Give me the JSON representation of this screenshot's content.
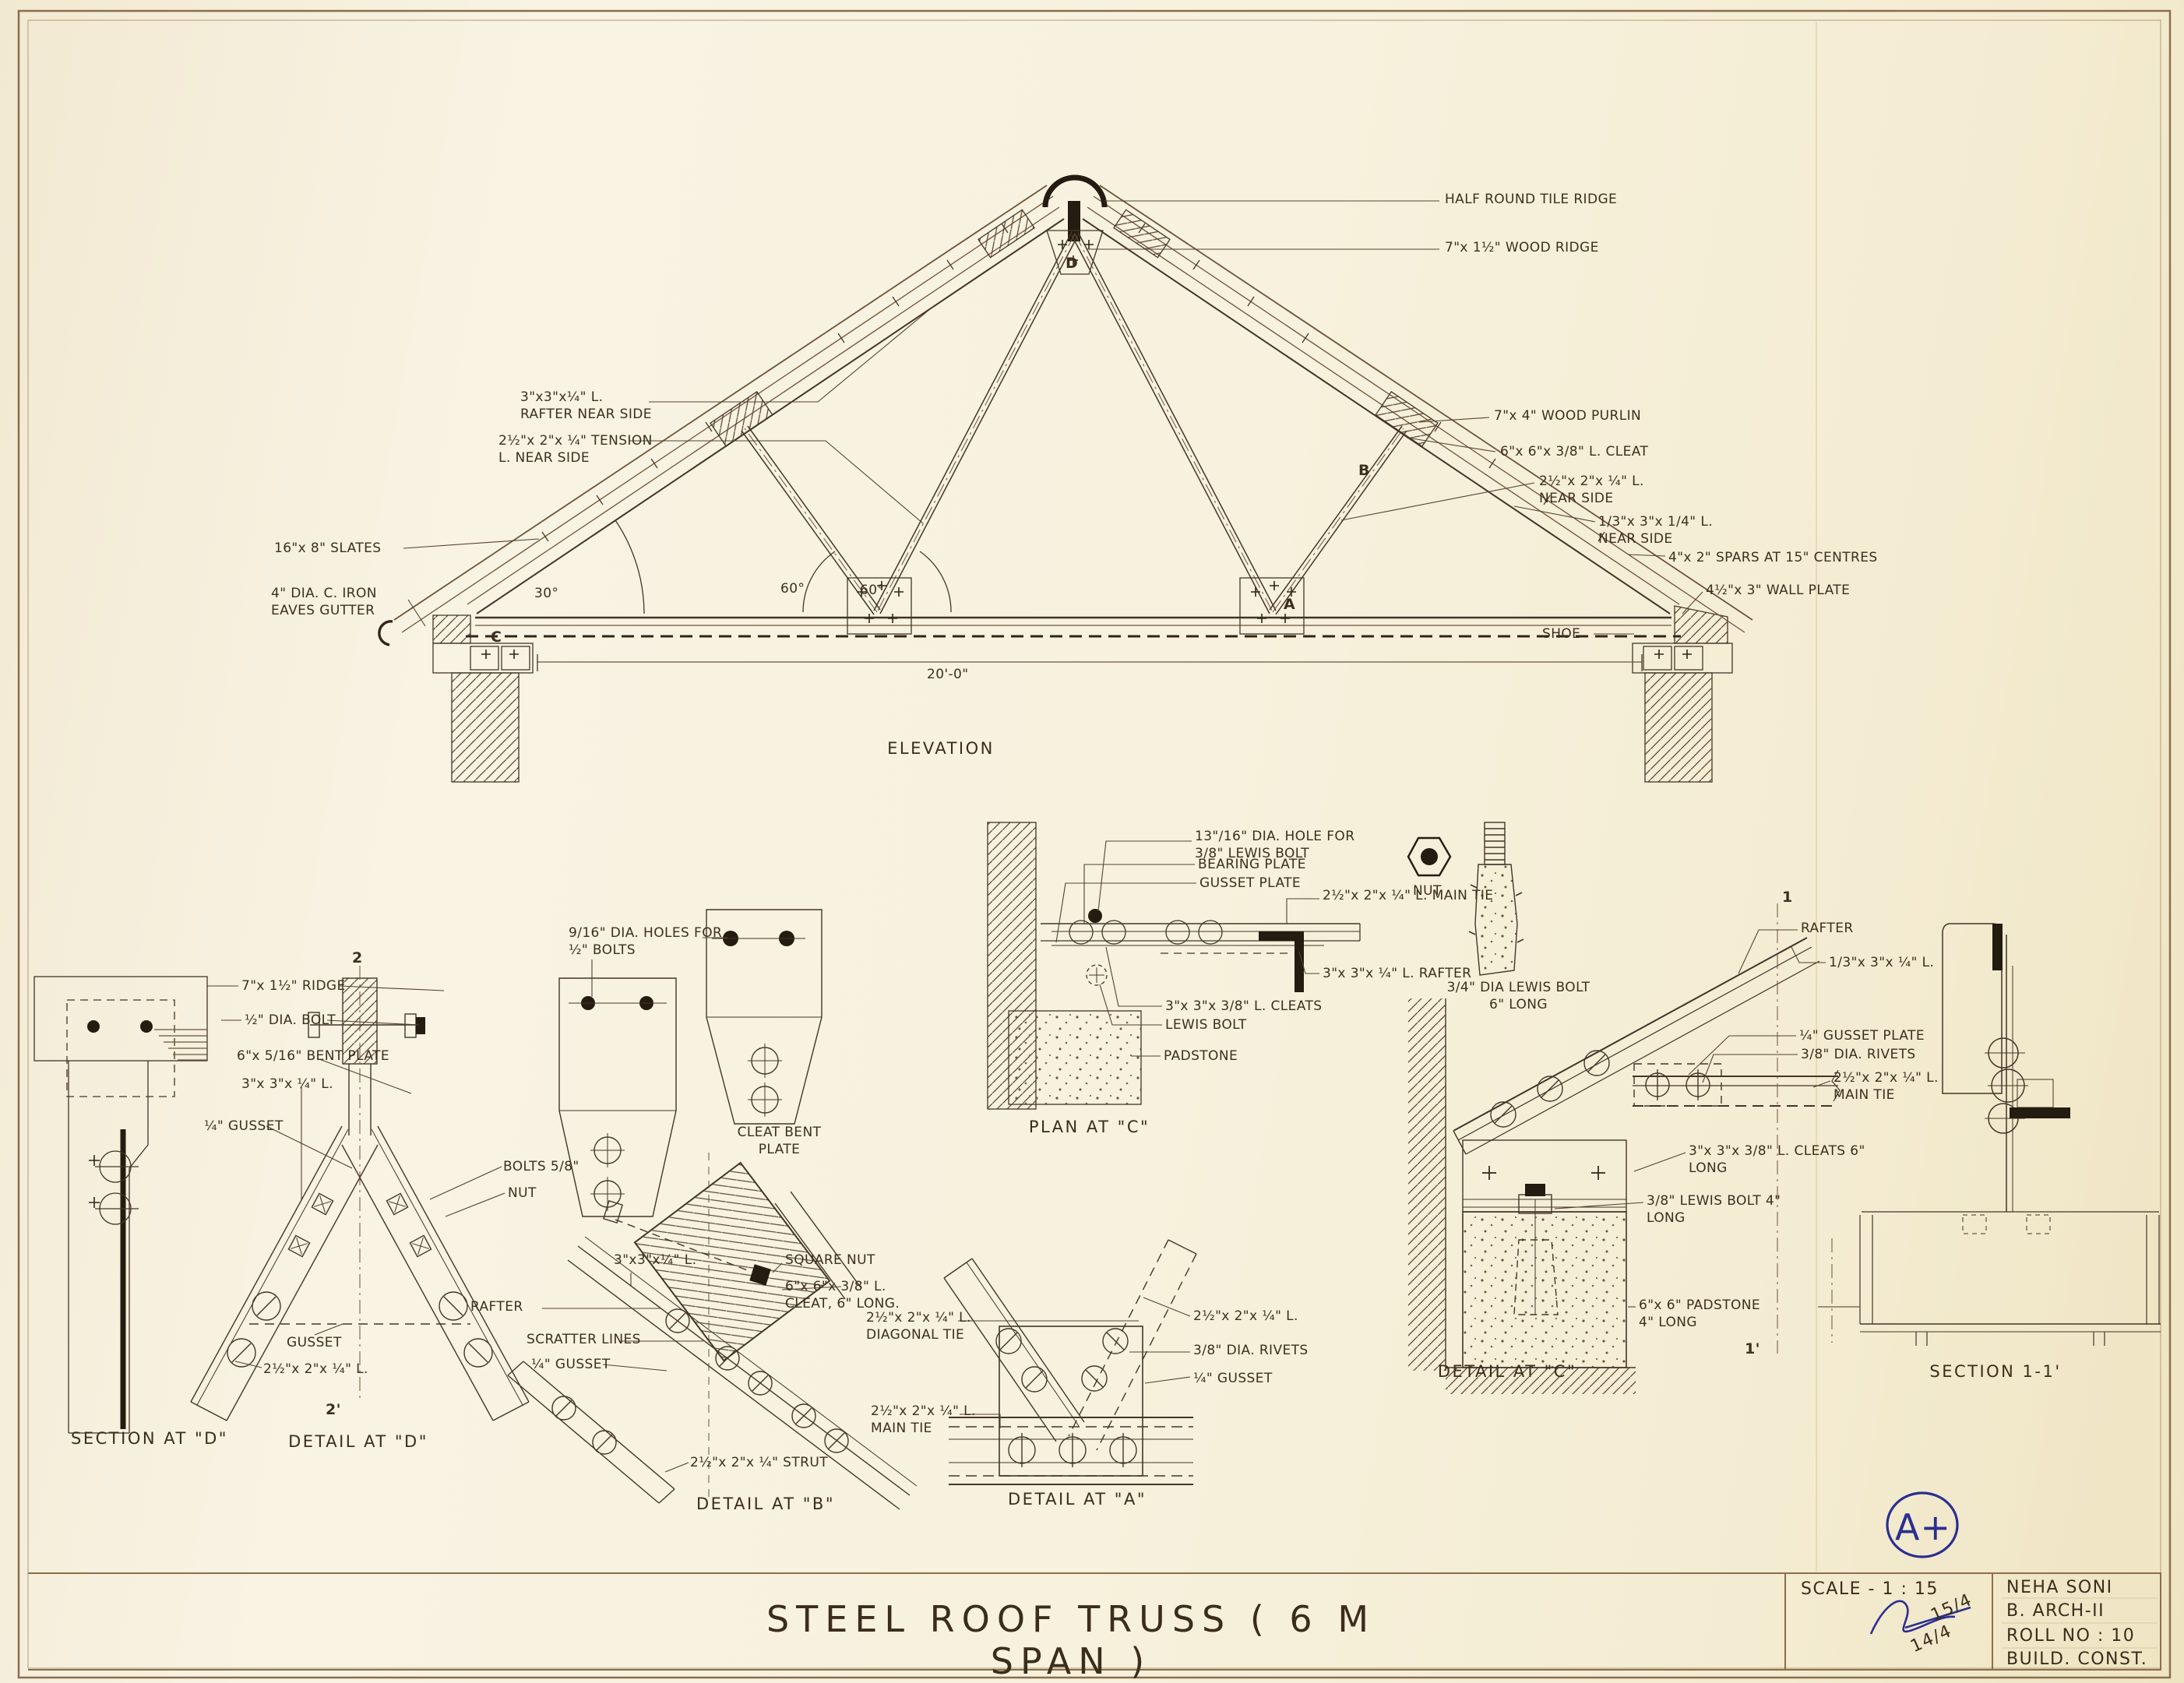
{
  "sheet": {
    "paper_color": "#f7f1dd",
    "ink_color": "#43352a",
    "accent_blue": "#2b2f91",
    "main_title": "STEEL ROOF TRUSS ( 6 M SPAN )",
    "grade": "A+"
  },
  "elevation": {
    "caption": "ELEVATION",
    "span": "20'-0\"",
    "angle_eaves": "30°",
    "angle_60_left": "60°",
    "angle_60_right": "60°",
    "node_a": "A",
    "node_b": "B",
    "node_c": "C",
    "node_d": "D",
    "shoe": "SHOE",
    "labels": {
      "rafter": "3\"x3\"x¼\" L. RAFTER NEAR SIDE",
      "tension": "2½\"x 2\"x ¼\" TENSION L. NEAR SIDE",
      "slates": "16\"x 8\" SLATES",
      "gutter": "4\" DIA. C. IRON EAVES GUTTER",
      "tile_ridge": "HALF ROUND TILE RIDGE",
      "wood_ridge": "7\"x 1½\" WOOD RIDGE",
      "purlin": "7\"x 4\" WOOD PURLIN",
      "cleat": "6\"x 6\"x 3/8\" L. CLEAT",
      "angle_near": "2½\"x 2\"x ¼\" L. NEAR SIDE",
      "angle_near2": "1/3\"x 3\"x 1/4\" L. NEAR SIDE",
      "spars": "4\"x 2\" SPARS AT 15\" CENTRES",
      "wall_plate": "4½\"x 3\" WALL PLATE"
    }
  },
  "section_d": {
    "caption": "SECTION AT \"D\"",
    "ridge": "7\"x 1½\" RIDGE",
    "bolt": "½\" DIA. BOLT",
    "bent_plate": "6\"x 5/16\" BENT PLATE",
    "angle": "3\"x 3\"x ¼\" L.",
    "gusset": "¼\" GUSSET"
  },
  "detail_d": {
    "caption": "DETAIL AT \"D\"",
    "bolts": "BOLTS 5/8\"",
    "nut": "NUT",
    "gusset": "GUSSET",
    "angle": "2½\"x 2\"x ¼\" L.",
    "marker_top": "2",
    "marker_bottom": "2'"
  },
  "plates": {
    "holes": "9/16\" DIA. HOLES FOR ½\" BOLTS",
    "caption": "CLEAT BENT PLATE"
  },
  "detail_b": {
    "caption": "DETAIL AT \"B\"",
    "rafter": "RAFTER",
    "scratter": "SCRATTER LINES",
    "gusset": "¼\" GUSSET",
    "angle": "3\"x3\"x¼\" L.",
    "square_nut": "SQUARE NUT",
    "cleat": "6\"x 6\"x 3/8\" L. CLEAT, 6\" LONG.",
    "diagonal_tie": "2½\"x 2\"x ¼\" L. DIAGONAL TIE",
    "main_tie": "2½\"x 2\"x ¼\" L. MAIN TIE",
    "strut": "2½\"x 2\"x ¼\" STRUT"
  },
  "detail_a": {
    "caption": "DETAIL AT \"A\"",
    "angle": "2½\"x 2\"x ¼\" L.",
    "rivets": "3/8\" DIA. RIVETS",
    "gusset": "¼\" GUSSET"
  },
  "plan_c": {
    "caption": "PLAN AT \"C\"",
    "hole": "13\"/16\" DIA. HOLE FOR 3/8\" LEWIS BOLT",
    "bearing": "BEARING PLATE",
    "gusset_plate": "GUSSET PLATE",
    "main_tie": "2½\"x 2\"x ¼\" L. MAIN TIE",
    "rafter": "3\"x 3\"x ¼\" L. RAFTER",
    "cleats": "3\"x 3\"x 3/8\" L. CLEATS",
    "lewis_bolt": "LEWIS BOLT",
    "padstone": "PADSTONE"
  },
  "hardware": {
    "nut": "NUT",
    "lewis_bolt": "3/4\" DIA LEWIS BOLT 6\" LONG"
  },
  "detail_c": {
    "caption": "DETAIL AT \"C\"",
    "rafter": "RAFTER",
    "angle": "1/3\"x 3\"x ¼\" L.",
    "gusset_plate": "¼\" GUSSET PLATE",
    "rivets": "3/8\" DIA. RIVETS",
    "main_tie": "2½\"x 2\"x ¼\" L. MAIN TIE",
    "cleats": "3\"x 3\"x 3/8\" L. CLEATS 6\" LONG",
    "lewis": "3/8\" LEWIS BOLT 4\" LONG",
    "padstone": "6\"x 6\" PADSTONE 4\" LONG",
    "marker_top": "1",
    "marker_bottom": "1'"
  },
  "section_11": {
    "caption": "SECTION 1-1'"
  },
  "title_block": {
    "scale": "SCALE - 1 : 15",
    "date1": "15/4",
    "date2": "14/4",
    "name": "NEHA SONI",
    "course": "B. ARCH-II",
    "roll": "ROLL NO : 10",
    "subject": "BUILD. CONST."
  }
}
